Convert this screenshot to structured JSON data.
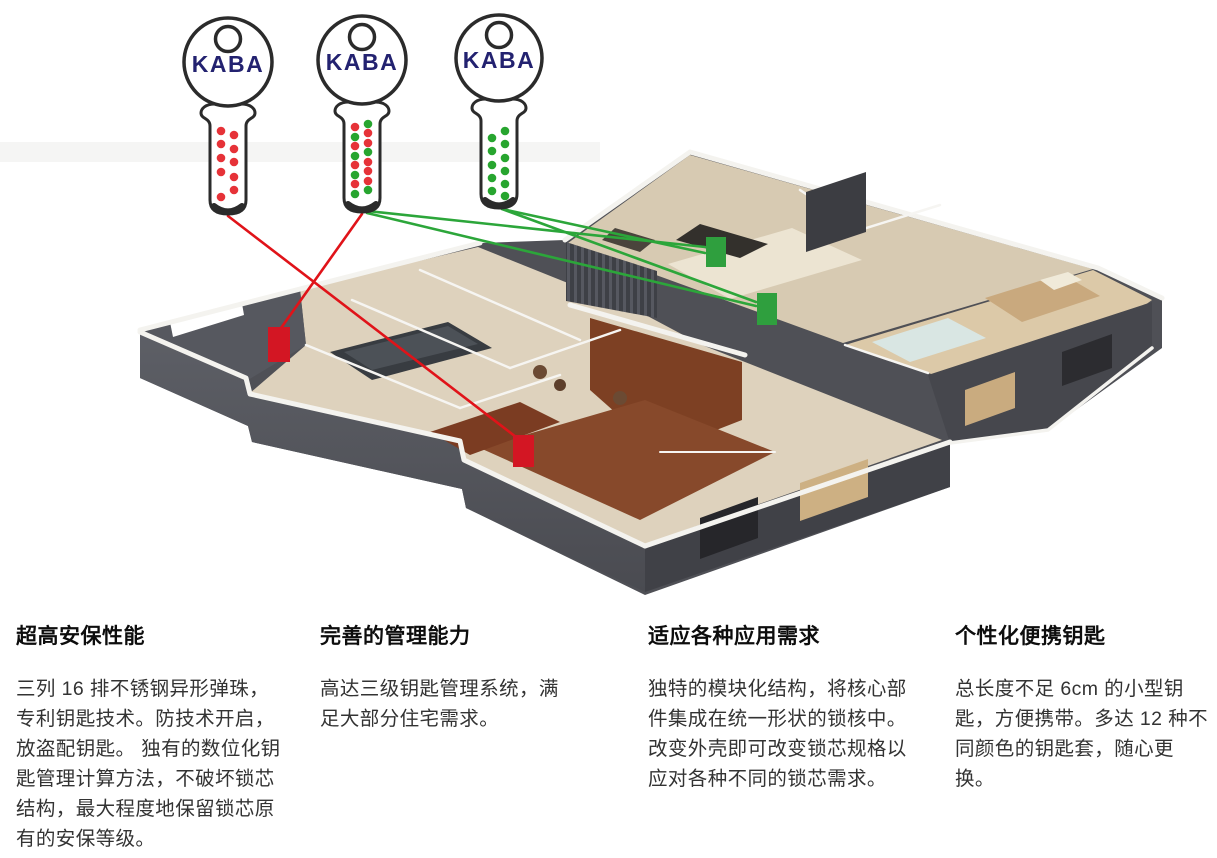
{
  "figure": {
    "colors": {
      "red_line": "#e01319",
      "green_line": "#2ca63a",
      "red_marker": "#d31623",
      "green_marker": "#2f9f3e",
      "dot_red": "#e63238",
      "dot_green": "#27a52f",
      "logo_navy": "#232270",
      "key_outline": "#2b2b2b"
    },
    "keys": [
      {
        "name": "key-red",
        "logo": "KABA",
        "geom": {
          "cx": 228,
          "head_cy": 62,
          "head_r": 44,
          "stem_bottom": 214
        },
        "dots": [
          {
            "x": 221,
            "y": 131,
            "c": "red"
          },
          {
            "x": 221,
            "y": 144,
            "c": "red"
          },
          {
            "x": 221,
            "y": 158,
            "c": "red"
          },
          {
            "x": 221,
            "y": 172,
            "c": "red"
          },
          {
            "x": 221,
            "y": 197,
            "c": "red"
          },
          {
            "x": 234,
            "y": 135,
            "c": "red"
          },
          {
            "x": 234,
            "y": 149,
            "c": "red"
          },
          {
            "x": 234,
            "y": 162,
            "c": "red"
          },
          {
            "x": 234,
            "y": 177,
            "c": "red"
          },
          {
            "x": 234,
            "y": 190,
            "c": "red"
          }
        ]
      },
      {
        "name": "key-master",
        "logo": "KABA",
        "geom": {
          "cx": 362,
          "head_cy": 60,
          "head_r": 44,
          "stem_bottom": 212
        },
        "dots": [
          {
            "x": 355,
            "y": 127,
            "c": "red"
          },
          {
            "x": 355,
            "y": 137,
            "c": "green"
          },
          {
            "x": 355,
            "y": 146,
            "c": "red"
          },
          {
            "x": 355,
            "y": 156,
            "c": "green"
          },
          {
            "x": 355,
            "y": 165,
            "c": "red"
          },
          {
            "x": 355,
            "y": 175,
            "c": "green"
          },
          {
            "x": 355,
            "y": 184,
            "c": "red"
          },
          {
            "x": 355,
            "y": 194,
            "c": "green"
          },
          {
            "x": 368,
            "y": 124,
            "c": "green"
          },
          {
            "x": 368,
            "y": 133,
            "c": "red"
          },
          {
            "x": 368,
            "y": 143,
            "c": "red"
          },
          {
            "x": 368,
            "y": 152,
            "c": "green"
          },
          {
            "x": 368,
            "y": 162,
            "c": "red"
          },
          {
            "x": 368,
            "y": 171,
            "c": "red"
          },
          {
            "x": 368,
            "y": 181,
            "c": "red"
          },
          {
            "x": 368,
            "y": 190,
            "c": "green"
          }
        ]
      },
      {
        "name": "key-green",
        "logo": "KABA",
        "geom": {
          "cx": 499,
          "head_cy": 58,
          "head_r": 43,
          "stem_bottom": 208
        },
        "dots": [
          {
            "x": 492,
            "y": 138,
            "c": "green"
          },
          {
            "x": 492,
            "y": 151,
            "c": "green"
          },
          {
            "x": 492,
            "y": 165,
            "c": "green"
          },
          {
            "x": 492,
            "y": 178,
            "c": "green"
          },
          {
            "x": 492,
            "y": 191,
            "c": "green"
          },
          {
            "x": 505,
            "y": 131,
            "c": "green"
          },
          {
            "x": 505,
            "y": 144,
            "c": "green"
          },
          {
            "x": 505,
            "y": 158,
            "c": "green"
          },
          {
            "x": 505,
            "y": 171,
            "c": "green"
          },
          {
            "x": 505,
            "y": 184,
            "c": "green"
          },
          {
            "x": 505,
            "y": 196,
            "c": "green"
          }
        ]
      }
    ],
    "connections": [
      {
        "color": "red",
        "from": [
          228,
          216
        ],
        "to": [
          516,
          437
        ]
      },
      {
        "color": "red",
        "from": [
          362,
          214
        ],
        "to": [
          281,
          328
        ]
      },
      {
        "color": "green",
        "from": [
          367,
          211
        ],
        "to": [
          705,
          247
        ]
      },
      {
        "color": "green",
        "from": [
          367,
          213
        ],
        "to": [
          756,
          306
        ]
      },
      {
        "color": "green",
        "from": [
          502,
          209
        ],
        "to": [
          705,
          253
        ]
      },
      {
        "color": "green",
        "from": [
          502,
          209
        ],
        "to": [
          756,
          302
        ]
      }
    ],
    "lock_markers": [
      {
        "name": "lock-marker-red-1",
        "color": "red",
        "x": 268,
        "y": 327,
        "w": 22,
        "h": 35
      },
      {
        "name": "lock-marker-red-2",
        "color": "red",
        "x": 513,
        "y": 435,
        "w": 21,
        "h": 32
      },
      {
        "name": "lock-marker-green-1",
        "color": "green",
        "x": 706,
        "y": 237,
        "w": 20,
        "h": 30
      },
      {
        "name": "lock-marker-green-2",
        "color": "green",
        "x": 757,
        "y": 293,
        "w": 20,
        "h": 32
      }
    ]
  },
  "features": [
    {
      "title": "超高安保性能",
      "body": "三列 16 排不锈钢异形弹珠，专利钥匙技术。防技术开启，放盗配钥匙。 独有的数位化钥匙管理计算方法，不破坏锁芯结构，最大程度地保留锁芯原有的安保等级。"
    },
    {
      "title": "完善的管理能力",
      "body": "高达三级钥匙管理系统，满足大部分住宅需求。"
    },
    {
      "title": "适应各种应用需求",
      "body": "独特的模块化结构，将核心部件集成在统一形状的锁核中。改变外壳即可改变锁芯规格以应对各种不同的锁芯需求。"
    },
    {
      "title": "个性化便携钥匙",
      "body": "总长度不足 6cm 的小型钥匙，方便携带。多达 12 种不同颜色的钥匙套，随心更换。"
    }
  ]
}
